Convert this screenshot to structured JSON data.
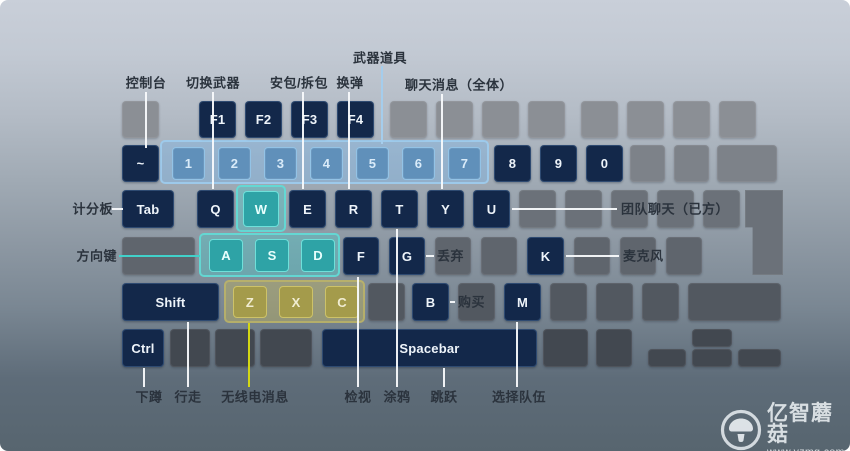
{
  "colors": {
    "background_top": "#c9cfd9",
    "background_bottom": "#57656f",
    "key_navy": "#13284a",
    "key_gray_light": "#8b8f95",
    "key_gray_dark": "#424850",
    "key_blue": "#6090ba",
    "key_cyan": "#2ea3a6",
    "key_olive": "#a49b4b",
    "line_white": "#f6f8fa",
    "line_cyan": "#41d1ca",
    "line_yellow": "#d3d714",
    "line_lightblue": "#a5cdec",
    "label_text": "#2b333d"
  },
  "keyboard": {
    "groups": [
      {
        "id": "numbers-1-7",
        "type": "g-blue",
        "x": 160,
        "y": 140,
        "w": 329,
        "h": 44
      },
      {
        "id": "w-key",
        "type": "g-cyan",
        "x": 236,
        "y": 185,
        "w": 50,
        "h": 47
      },
      {
        "id": "asd-keys",
        "type": "g-cyan",
        "x": 199,
        "y": 233,
        "w": 141,
        "h": 44
      },
      {
        "id": "zxc-keys",
        "type": "g-olive",
        "x": 224,
        "y": 280,
        "w": 141,
        "h": 43
      }
    ],
    "keys": [
      {
        "id": "esc",
        "label": "",
        "type": "k-gray1",
        "x": 122,
        "y": 101,
        "w": 37,
        "h": 37
      },
      {
        "id": "f1",
        "label": "F1",
        "type": "k-navy",
        "x": 199,
        "y": 101,
        "w": 37,
        "h": 37
      },
      {
        "id": "f2",
        "label": "F2",
        "type": "k-navy",
        "x": 245,
        "y": 101,
        "w": 37,
        "h": 37
      },
      {
        "id": "f3",
        "label": "F3",
        "type": "k-navy",
        "x": 291,
        "y": 101,
        "w": 37,
        "h": 37
      },
      {
        "id": "f4",
        "label": "F4",
        "type": "k-navy",
        "x": 337,
        "y": 101,
        "w": 37,
        "h": 37
      },
      {
        "id": "f5",
        "label": "",
        "type": "k-gray1",
        "x": 390,
        "y": 101,
        "w": 37,
        "h": 37
      },
      {
        "id": "f6",
        "label": "",
        "type": "k-gray1",
        "x": 436,
        "y": 101,
        "w": 37,
        "h": 37
      },
      {
        "id": "f7",
        "label": "",
        "type": "k-gray1",
        "x": 482,
        "y": 101,
        "w": 37,
        "h": 37
      },
      {
        "id": "f8",
        "label": "",
        "type": "k-gray1",
        "x": 528,
        "y": 101,
        "w": 37,
        "h": 37
      },
      {
        "id": "f9",
        "label": "",
        "type": "k-gray1",
        "x": 581,
        "y": 101,
        "w": 37,
        "h": 37
      },
      {
        "id": "f10",
        "label": "",
        "type": "k-gray1",
        "x": 627,
        "y": 101,
        "w": 37,
        "h": 37
      },
      {
        "id": "f11",
        "label": "",
        "type": "k-gray1",
        "x": 673,
        "y": 101,
        "w": 37,
        "h": 37
      },
      {
        "id": "f12",
        "label": "",
        "type": "k-gray1",
        "x": 719,
        "y": 101,
        "w": 37,
        "h": 37
      },
      {
        "id": "grave",
        "label": "~",
        "type": "k-navy",
        "x": 122,
        "y": 145,
        "w": 37,
        "h": 37
      },
      {
        "id": "num1",
        "label": "1",
        "type": "k-blue",
        "x": 172,
        "y": 147,
        "w": 33,
        "h": 33
      },
      {
        "id": "num2",
        "label": "2",
        "type": "k-blue",
        "x": 218,
        "y": 147,
        "w": 33,
        "h": 33
      },
      {
        "id": "num3",
        "label": "3",
        "type": "k-blue",
        "x": 264,
        "y": 147,
        "w": 33,
        "h": 33
      },
      {
        "id": "num4",
        "label": "4",
        "type": "k-blue",
        "x": 310,
        "y": 147,
        "w": 33,
        "h": 33
      },
      {
        "id": "num5",
        "label": "5",
        "type": "k-blue",
        "x": 356,
        "y": 147,
        "w": 33,
        "h": 33
      },
      {
        "id": "num6",
        "label": "6",
        "type": "k-blue",
        "x": 402,
        "y": 147,
        "w": 33,
        "h": 33
      },
      {
        "id": "num7",
        "label": "7",
        "type": "k-blue",
        "x": 448,
        "y": 147,
        "w": 33,
        "h": 33
      },
      {
        "id": "num8",
        "label": "8",
        "type": "k-navy",
        "x": 494,
        "y": 145,
        "w": 37,
        "h": 37
      },
      {
        "id": "num9",
        "label": "9",
        "type": "k-navy",
        "x": 540,
        "y": 145,
        "w": 37,
        "h": 37
      },
      {
        "id": "num0",
        "label": "0",
        "type": "k-navy",
        "x": 586,
        "y": 145,
        "w": 37,
        "h": 37
      },
      {
        "id": "minus",
        "label": "",
        "type": "k-gray2",
        "x": 630,
        "y": 145,
        "w": 35,
        "h": 37
      },
      {
        "id": "equals",
        "label": "",
        "type": "k-gray2",
        "x": 674,
        "y": 145,
        "w": 35,
        "h": 37
      },
      {
        "id": "backspace",
        "label": "",
        "type": "k-gray2",
        "x": 717,
        "y": 145,
        "w": 60,
        "h": 37
      },
      {
        "id": "tab",
        "label": "Tab",
        "type": "k-navy",
        "x": 122,
        "y": 190,
        "w": 52,
        "h": 38
      },
      {
        "id": "q",
        "label": "Q",
        "type": "k-navy",
        "x": 197,
        "y": 190,
        "w": 37,
        "h": 38
      },
      {
        "id": "w",
        "label": "W",
        "type": "k-cyan",
        "x": 243,
        "y": 191,
        "w": 36,
        "h": 36
      },
      {
        "id": "e",
        "label": "E",
        "type": "k-navy",
        "x": 289,
        "y": 190,
        "w": 37,
        "h": 38
      },
      {
        "id": "r",
        "label": "R",
        "type": "k-navy",
        "x": 335,
        "y": 190,
        "w": 37,
        "h": 38
      },
      {
        "id": "t",
        "label": "T",
        "type": "k-navy",
        "x": 381,
        "y": 190,
        "w": 37,
        "h": 38
      },
      {
        "id": "y",
        "label": "Y",
        "type": "k-navy",
        "x": 427,
        "y": 190,
        "w": 37,
        "h": 38
      },
      {
        "id": "u",
        "label": "U",
        "type": "k-navy",
        "x": 473,
        "y": 190,
        "w": 37,
        "h": 38
      },
      {
        "id": "i",
        "label": "",
        "type": "k-gray3",
        "x": 519,
        "y": 190,
        "w": 37,
        "h": 38
      },
      {
        "id": "o",
        "label": "",
        "type": "k-gray3",
        "x": 565,
        "y": 190,
        "w": 37,
        "h": 38
      },
      {
        "id": "p",
        "label": "",
        "type": "k-gray3",
        "x": 611,
        "y": 190,
        "w": 37,
        "h": 38
      },
      {
        "id": "bracket-left",
        "label": "",
        "type": "k-gray3",
        "x": 657,
        "y": 190,
        "w": 37,
        "h": 38
      },
      {
        "id": "bracket-right",
        "label": "",
        "type": "k-gray3",
        "x": 703,
        "y": 190,
        "w": 37,
        "h": 38
      },
      {
        "id": "enter",
        "label": "",
        "type": "k-gray3 enter-iso",
        "x": 745,
        "y": 190,
        "w": 38,
        "h": 85
      },
      {
        "id": "capslock",
        "label": "",
        "type": "k-gray4",
        "x": 122,
        "y": 237,
        "w": 73,
        "h": 38
      },
      {
        "id": "a",
        "label": "A",
        "type": "k-cyan",
        "x": 209,
        "y": 239,
        "w": 34,
        "h": 33
      },
      {
        "id": "s",
        "label": "S",
        "type": "k-cyan",
        "x": 255,
        "y": 239,
        "w": 34,
        "h": 33
      },
      {
        "id": "d",
        "label": "D",
        "type": "k-cyan",
        "x": 301,
        "y": 239,
        "w": 34,
        "h": 33
      },
      {
        "id": "f",
        "label": "F",
        "type": "k-navy",
        "x": 343,
        "y": 237,
        "w": 36,
        "h": 38
      },
      {
        "id": "g",
        "label": "G",
        "type": "k-navy",
        "x": 389,
        "y": 237,
        "w": 36,
        "h": 38
      },
      {
        "id": "h",
        "label": "",
        "type": "k-gray4",
        "x": 435,
        "y": 237,
        "w": 36,
        "h": 38
      },
      {
        "id": "j",
        "label": "",
        "type": "k-gray4",
        "x": 481,
        "y": 237,
        "w": 36,
        "h": 38
      },
      {
        "id": "k",
        "label": "K",
        "type": "k-navy",
        "x": 527,
        "y": 237,
        "w": 37,
        "h": 38
      },
      {
        "id": "l",
        "label": "",
        "type": "k-gray4",
        "x": 574,
        "y": 237,
        "w": 36,
        "h": 38
      },
      {
        "id": "semicolon",
        "label": "",
        "type": "k-gray4",
        "x": 620,
        "y": 237,
        "w": 36,
        "h": 38
      },
      {
        "id": "quote",
        "label": "",
        "type": "k-gray4",
        "x": 666,
        "y": 237,
        "w": 36,
        "h": 38
      },
      {
        "id": "shift-left",
        "label": "Shift",
        "type": "k-navy",
        "x": 122,
        "y": 283,
        "w": 97,
        "h": 38
      },
      {
        "id": "z",
        "label": "Z",
        "type": "k-olive",
        "x": 233,
        "y": 286,
        "w": 34,
        "h": 32
      },
      {
        "id": "x",
        "label": "X",
        "type": "k-olive",
        "x": 279,
        "y": 286,
        "w": 34,
        "h": 32
      },
      {
        "id": "c",
        "label": "C",
        "type": "k-olive",
        "x": 325,
        "y": 286,
        "w": 34,
        "h": 32
      },
      {
        "id": "v",
        "label": "",
        "type": "k-gray5",
        "x": 368,
        "y": 283,
        "w": 37,
        "h": 38
      },
      {
        "id": "b",
        "label": "B",
        "type": "k-navy",
        "x": 412,
        "y": 283,
        "w": 37,
        "h": 38
      },
      {
        "id": "n",
        "label": "",
        "type": "k-gray5",
        "x": 458,
        "y": 283,
        "w": 37,
        "h": 38
      },
      {
        "id": "m",
        "label": "M",
        "type": "k-navy",
        "x": 504,
        "y": 283,
        "w": 37,
        "h": 38
      },
      {
        "id": "comma",
        "label": "",
        "type": "k-gray5",
        "x": 550,
        "y": 283,
        "w": 37,
        "h": 38
      },
      {
        "id": "period",
        "label": "",
        "type": "k-gray5",
        "x": 596,
        "y": 283,
        "w": 37,
        "h": 38
      },
      {
        "id": "slash",
        "label": "",
        "type": "k-gray5",
        "x": 642,
        "y": 283,
        "w": 37,
        "h": 38
      },
      {
        "id": "shift-right",
        "label": "",
        "type": "k-gray5",
        "x": 688,
        "y": 283,
        "w": 93,
        "h": 38
      },
      {
        "id": "ctrl-left",
        "label": "Ctrl",
        "type": "k-navy",
        "x": 122,
        "y": 329,
        "w": 42,
        "h": 38
      },
      {
        "id": "win",
        "label": "",
        "type": "k-gray6",
        "x": 170,
        "y": 329,
        "w": 40,
        "h": 38
      },
      {
        "id": "alt-left",
        "label": "",
        "type": "k-gray6",
        "x": 215,
        "y": 329,
        "w": 40,
        "h": 38
      },
      {
        "id": "menu-left",
        "label": "",
        "type": "k-gray6",
        "x": 260,
        "y": 329,
        "w": 52,
        "h": 38
      },
      {
        "id": "spacebar",
        "label": "Spacebar",
        "type": "k-navy",
        "x": 322,
        "y": 329,
        "w": 215,
        "h": 38
      },
      {
        "id": "alt-right",
        "label": "",
        "type": "k-gray6",
        "x": 543,
        "y": 329,
        "w": 45,
        "h": 38
      },
      {
        "id": "menu-right",
        "label": "",
        "type": "k-gray6",
        "x": 596,
        "y": 329,
        "w": 36,
        "h": 38
      },
      {
        "id": "arrow-left",
        "label": "",
        "type": "k-gray6",
        "x": 648,
        "y": 349,
        "w": 38,
        "h": 18
      },
      {
        "id": "arrow-up",
        "label": "",
        "type": "k-gray6",
        "x": 692,
        "y": 329,
        "w": 40,
        "h": 18
      },
      {
        "id": "arrow-down",
        "label": "",
        "type": "k-gray6",
        "x": 692,
        "y": 349,
        "w": 40,
        "h": 18
      },
      {
        "id": "arrow-right",
        "label": "",
        "type": "k-gray6",
        "x": 738,
        "y": 349,
        "w": 43,
        "h": 18
      }
    ]
  },
  "annotations": [
    {
      "id": "console",
      "text": "控制台",
      "key": "~",
      "anchor": "center",
      "tx": 146,
      "ty": 82,
      "lines": [
        {
          "dir": "v",
          "x": 145,
          "y1": 92,
          "y2": 148,
          "color": "white"
        }
      ]
    },
    {
      "id": "switch-weapons",
      "text": "切换武器",
      "key": "Q",
      "anchor": "center",
      "tx": 213,
      "ty": 82,
      "lines": [
        {
          "dir": "v",
          "x": 212,
          "y1": 92,
          "y2": 189,
          "color": "white"
        }
      ]
    },
    {
      "id": "plant-defuse",
      "text": "安包/拆包",
      "key": "E",
      "anchor": "center",
      "tx": 299,
      "ty": 82,
      "lines": [
        {
          "dir": "v",
          "x": 302,
          "y1": 92,
          "y2": 189,
          "color": "white"
        }
      ]
    },
    {
      "id": "reload",
      "text": "换弹",
      "key": "R",
      "anchor": "center",
      "tx": 350,
      "ty": 82,
      "lines": [
        {
          "dir": "v",
          "x": 348,
          "y1": 92,
          "y2": 189,
          "color": "white"
        }
      ]
    },
    {
      "id": "weapon-items",
      "text": "武器道具",
      "key": "1-7",
      "anchor": "center",
      "tx": 380,
      "ty": 57,
      "lines": [
        {
          "dir": "v",
          "x": 381,
          "y1": 66,
          "y2": 144,
          "color": "lightblue"
        }
      ]
    },
    {
      "id": "chat-all",
      "text": "聊天消息（全体）",
      "key": "Y",
      "anchor": "center",
      "tx": 459,
      "ty": 84,
      "lines": [
        {
          "dir": "v",
          "x": 441,
          "y1": 94,
          "y2": 189,
          "color": "white"
        }
      ]
    },
    {
      "id": "scoreboard",
      "text": "计分板",
      "key": "Tab",
      "anchor": "right",
      "tx": 113,
      "ty": 208,
      "lines": [
        {
          "dir": "h",
          "y": 208,
          "x1": 112,
          "x2": 123,
          "color": "white"
        }
      ]
    },
    {
      "id": "team-chat",
      "text": "团队聊天（已方）",
      "key": "U",
      "anchor": "left",
      "tx": 621,
      "ty": 208,
      "lines": [
        {
          "dir": "h",
          "y": 208,
          "x1": 512,
          "x2": 617,
          "color": "white"
        }
      ]
    },
    {
      "id": "movement-keys",
      "text": "方向键",
      "key": "WASD",
      "anchor": "right",
      "tx": 117,
      "ty": 255,
      "lines": [
        {
          "dir": "h",
          "y": 255,
          "x1": 119,
          "x2": 200,
          "color": "cyan"
        }
      ]
    },
    {
      "id": "drop",
      "text": "丢弃",
      "key": "G",
      "anchor": "left",
      "tx": 437,
      "ty": 255,
      "lines": [
        {
          "dir": "h",
          "y": 255,
          "x1": 426,
          "x2": 434,
          "color": "white"
        }
      ]
    },
    {
      "id": "microphone",
      "text": "麦克风",
      "key": "K",
      "anchor": "left",
      "tx": 623,
      "ty": 255,
      "lines": [
        {
          "dir": "h",
          "y": 255,
          "x1": 566,
          "x2": 619,
          "color": "white"
        }
      ]
    },
    {
      "id": "buy",
      "text": "购买",
      "key": "B",
      "anchor": "left",
      "tx": 458,
      "ty": 301,
      "lines": [
        {
          "dir": "h",
          "y": 301,
          "x1": 450,
          "x2": 455,
          "color": "white"
        }
      ]
    },
    {
      "id": "crouch",
      "text": "下蹲",
      "key": "Ctrl",
      "anchor": "center",
      "tx": 149,
      "ty": 396,
      "lines": [
        {
          "dir": "v",
          "x": 143,
          "y1": 368,
          "y2": 387,
          "color": "white"
        }
      ]
    },
    {
      "id": "walk",
      "text": "行走",
      "key": "Shift",
      "anchor": "center",
      "tx": 188,
      "ty": 396,
      "lines": [
        {
          "dir": "v",
          "x": 187,
          "y1": 322,
          "y2": 387,
          "color": "white"
        }
      ]
    },
    {
      "id": "radio-message",
      "text": "无线电消息",
      "key": "Z",
      "anchor": "center",
      "tx": 255,
      "ty": 396,
      "lines": [
        {
          "dir": "v",
          "x": 248,
          "y1": 323,
          "y2": 387,
          "color": "yellow"
        }
      ]
    },
    {
      "id": "inspect",
      "text": "检视",
      "key": "F",
      "anchor": "center",
      "tx": 358,
      "ty": 396,
      "lines": [
        {
          "dir": "v",
          "x": 357,
          "y1": 277,
          "y2": 387,
          "color": "white"
        }
      ]
    },
    {
      "id": "graffiti",
      "text": "涂鸦",
      "key": "T",
      "anchor": "center",
      "tx": 397,
      "ty": 396,
      "lines": [
        {
          "dir": "v",
          "x": 396,
          "y1": 229,
          "y2": 387,
          "color": "white"
        }
      ]
    },
    {
      "id": "jump",
      "text": "跳跃",
      "key": "Spacebar",
      "anchor": "center",
      "tx": 444,
      "ty": 396,
      "lines": [
        {
          "dir": "v",
          "x": 443,
          "y1": 368,
          "y2": 387,
          "color": "white"
        }
      ]
    },
    {
      "id": "choose-team",
      "text": "选择队伍",
      "key": "M",
      "anchor": "center",
      "tx": 519,
      "ty": 396,
      "lines": [
        {
          "dir": "v",
          "x": 516,
          "y1": 322,
          "y2": 387,
          "color": "white"
        }
      ]
    }
  ],
  "watermark": {
    "brand": "亿智蘑菇",
    "url": "www.yzmg.com",
    "icon": "mushroom-icon"
  }
}
